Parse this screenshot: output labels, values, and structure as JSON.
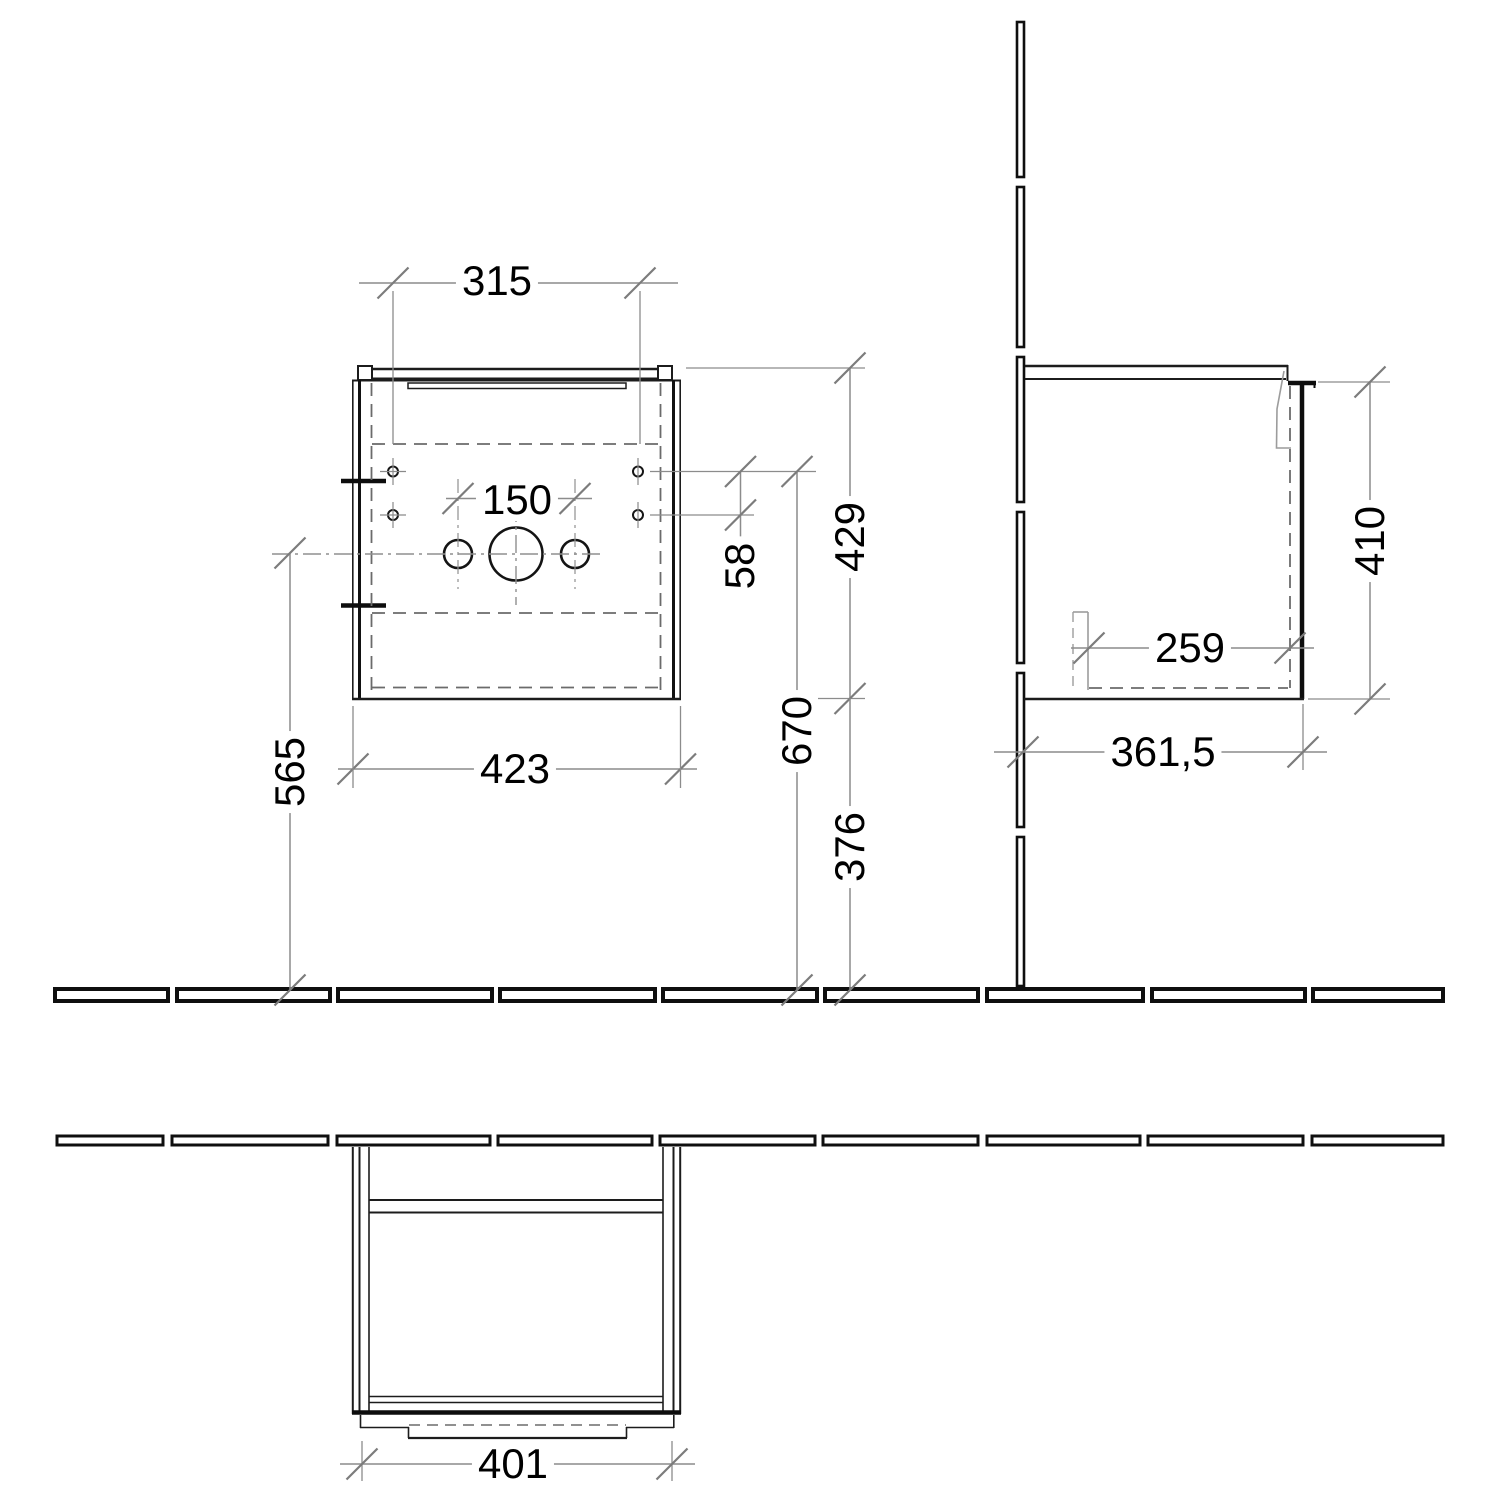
{
  "dims": {
    "front": {
      "top_width": "315",
      "faucet_spacing": "150",
      "hole_gap": "58",
      "total_height": "429",
      "holes_to_floor": "670",
      "bottom_to_floor": "376",
      "center_to_floor": "565",
      "total_width": "423"
    },
    "side": {
      "body_height": "410",
      "inner_depth": "259",
      "total_depth": "361,5"
    },
    "plan": {
      "door_width": "401"
    }
  }
}
